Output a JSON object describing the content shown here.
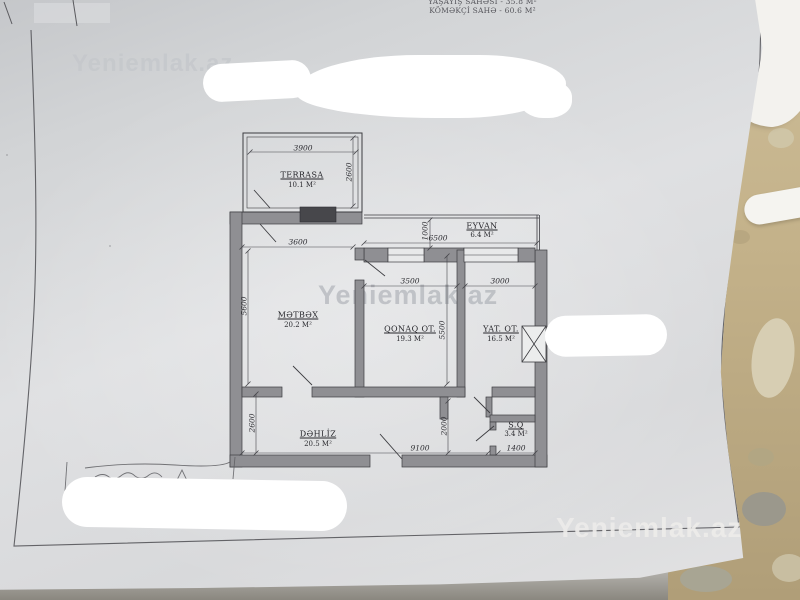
{
  "header": {
    "line1": "YAŞAYIŞ SAHƏSİ - 35.8 M²",
    "line2": "KÖMƏKÇİ SAHƏ - 60.6 M²"
  },
  "watermark": {
    "text": "Yeniemlak.az"
  },
  "plan": {
    "rooms": [
      {
        "name": "TERRASA",
        "area": "10.1 M²"
      },
      {
        "name": "EYVAN",
        "area": "6.4 M²"
      },
      {
        "name": "MƏTBƏX",
        "area": "20.2 M²"
      },
      {
        "name": "QONAQ OT.",
        "area": "19.3 M²"
      },
      {
        "name": "YAT. OT.",
        "area": "16.5 M²"
      },
      {
        "name": "DƏHLİZ",
        "area": "20.5 M²"
      },
      {
        "name": "S.Q",
        "area": "3.4 M²"
      }
    ],
    "dims": {
      "terrace_width": "3900",
      "terrace_depth": "2600",
      "kitchen_width": "3600",
      "kitchen_depth": "5600",
      "eyvan_width": "6500",
      "eyvan_depth": "1000",
      "living_width": "3500",
      "living_depth": "5500",
      "bedroom_width": "3000",
      "hall_depth": "2600",
      "corridor_depth": "2000",
      "total_width": "9100",
      "wc_width": "1400"
    }
  },
  "colors": {
    "paper": "#dcdee0",
    "sand": "#c3b189",
    "ink": "#3a3a3e",
    "whiteout": "#ffffff",
    "watermark_gray": "#a9adb3"
  }
}
